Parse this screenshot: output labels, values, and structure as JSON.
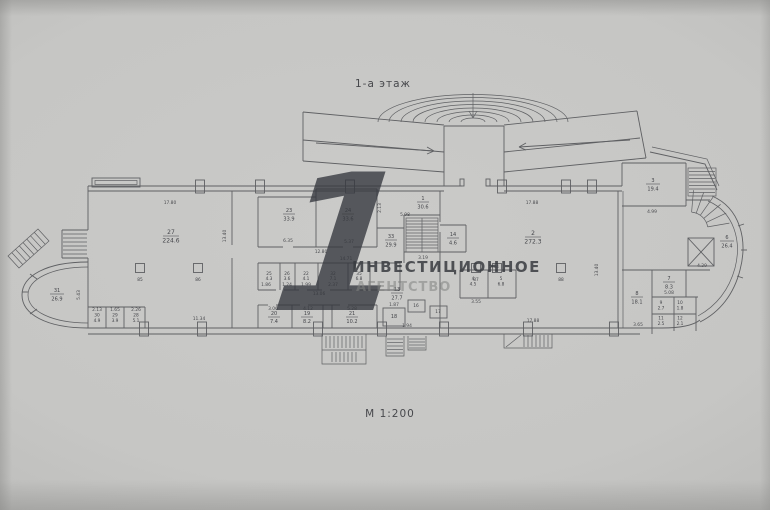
{
  "plan": {
    "title": "1-а этаж",
    "scale": "М 1:200"
  },
  "watermark": {
    "digit": "1",
    "line1": "ИНВЕСТИЦИОННОЕ",
    "line2": "АГЕНТСТВО"
  },
  "colors": {
    "paper": "#c6c6c4",
    "ink": "#5f6063",
    "watermark_dark": "#34373d",
    "watermark_light": "#828482"
  },
  "rooms": {
    "r1": {
      "num": "1",
      "area": "30.6"
    },
    "r2": {
      "num": "2",
      "area": "272.3"
    },
    "r3": {
      "num": "3",
      "area": "19.4"
    },
    "r4": {
      "num": "4",
      "area": "4.5"
    },
    "r5": {
      "num": "5",
      "area": "6.8"
    },
    "r6": {
      "num": "6",
      "area": "26.4"
    },
    "r7": {
      "num": "7",
      "area": "8.3"
    },
    "r8": {
      "num": "8",
      "area": "18.1"
    },
    "r9": {
      "num": "9",
      "area": "2.7"
    },
    "r10": {
      "num": "10",
      "area": "1.8"
    },
    "r11": {
      "num": "11",
      "area": "2.5"
    },
    "r12": {
      "num": "12",
      "area": "2.1"
    },
    "r13": {
      "num": "13",
      "area": "27.7"
    },
    "r14": {
      "num": "14",
      "area": "4.6"
    },
    "r16": {
      "num": "16"
    },
    "r17": {
      "num": "17"
    },
    "r18": {
      "num": "18"
    },
    "r19": {
      "num": "19",
      "area": "8.2"
    },
    "r20": {
      "num": "20",
      "area": "7.4"
    },
    "r21": {
      "num": "21",
      "area": "10.2"
    },
    "r22": {
      "num": "22",
      "area": "4.1"
    },
    "r23": {
      "num": "23",
      "area": "33.9"
    },
    "r24": {
      "num": "24",
      "area": "33.6"
    },
    "r25": {
      "num": "25",
      "area": "4.3"
    },
    "r26": {
      "num": "26",
      "area": "3.6"
    },
    "r27": {
      "num": "27",
      "area": "224.6"
    },
    "r28": {
      "num": "28",
      "area": "5.1"
    },
    "r29": {
      "num": "29",
      "area": "3.9"
    },
    "r30": {
      "num": "30",
      "area": "4.9"
    },
    "r31": {
      "num": "31",
      "area": "26.9"
    },
    "r32": {
      "num": "32",
      "area": "7.1"
    },
    "r33": {
      "num": "33",
      "area": "29.9"
    },
    "r35": {
      "num": "35",
      "area": "6.8"
    }
  },
  "columns": {
    "c85": "85",
    "c86": "86",
    "c87": "87",
    "c88": "88"
  },
  "dims": {
    "d17_80": "17.80",
    "d13_40a": "13.40",
    "d6_35": "6.35",
    "d5_37": "5.37",
    "d12_80": "12.80",
    "d14_71": "14.71",
    "d2_13a": "2.13",
    "d5_98": "5.98",
    "d3_19": "3.19",
    "d1_86": "1.86",
    "d1_24": "1.24",
    "d1_99": "1.99",
    "d2_37": "2.37",
    "d13_06": "13.06",
    "d11_34": "11.34",
    "d2_13b": "2.13",
    "d1_65": "1.65",
    "d2_26": "2.26",
    "d3_06": "3.06",
    "d4_12": "4.12",
    "d5_28": "5.28",
    "d1_87": "1.87",
    "d1_94": "1.94",
    "d5_34": "5.34",
    "d3_55": "3.55",
    "d17_88a": "17.88",
    "d17_88b": "17.88",
    "d13_40b": "13.40",
    "d4_99": "4.99",
    "d4_29": "4.29",
    "d5_08": "5.08",
    "d3_65": "3.65",
    "d5_43": "5.43"
  }
}
